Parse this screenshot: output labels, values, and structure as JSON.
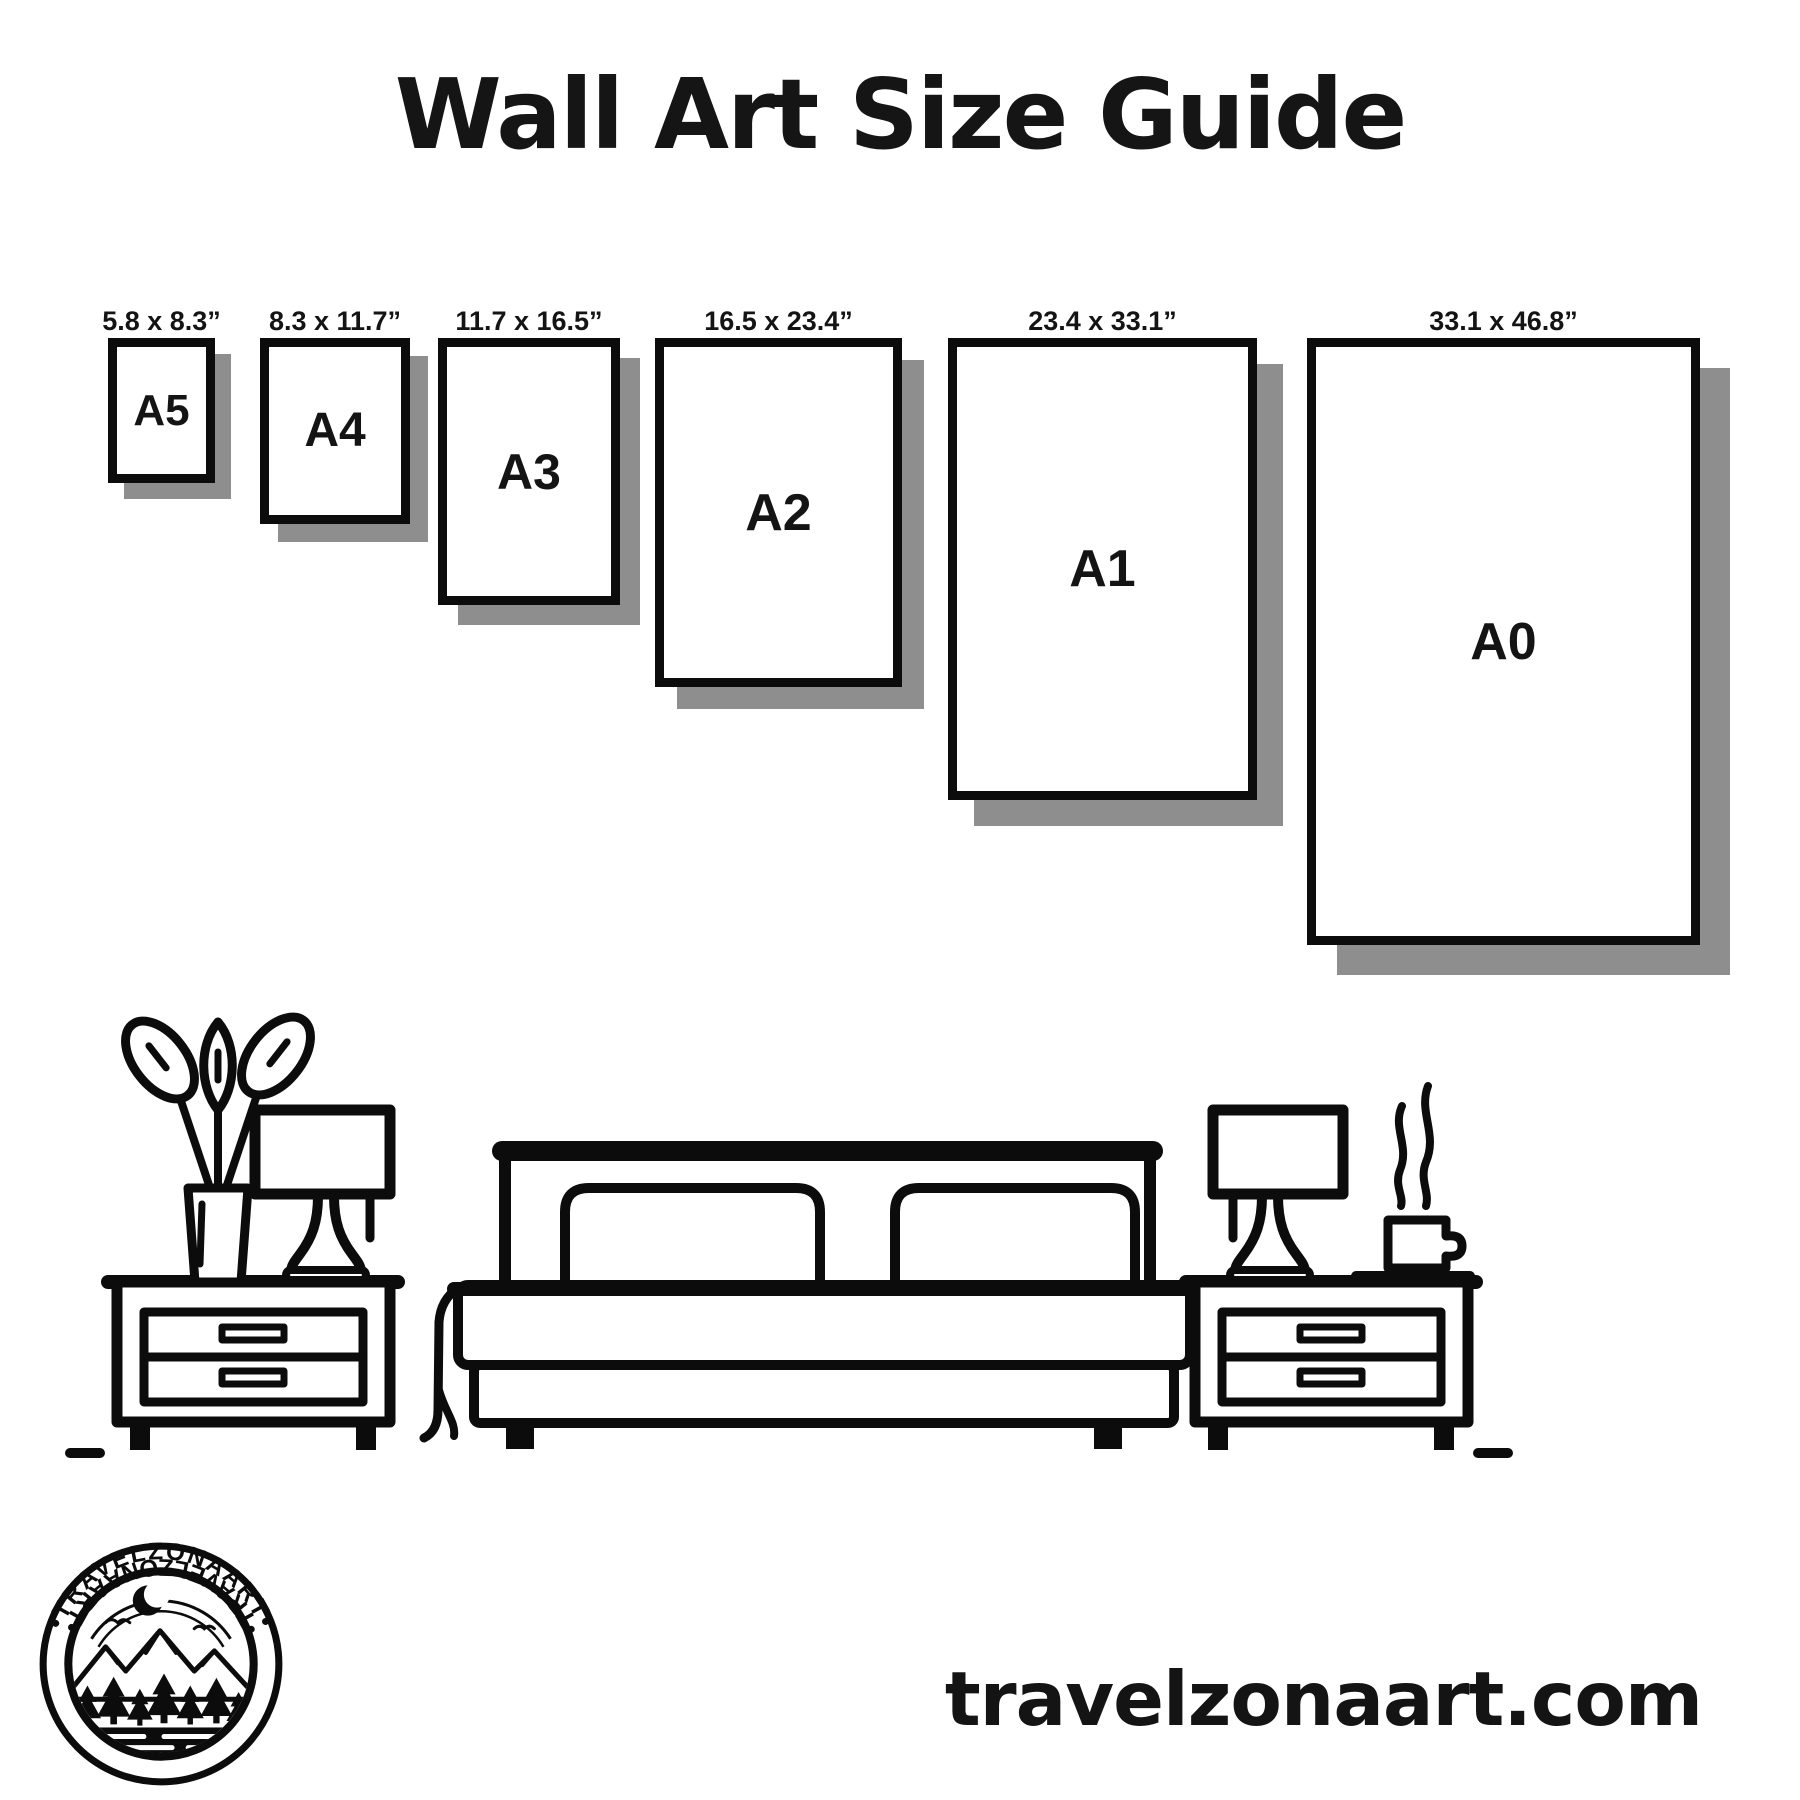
{
  "page": {
    "title": "Wall Art Size Guide",
    "website": "travelzonaart.com"
  },
  "colors": {
    "background": "#ffffff",
    "ink": "#0c0c0c",
    "shadow_gray": "#8e8e8e"
  },
  "sizes": [
    {
      "name": "A5",
      "dimensions": "5.8 x 8.3”",
      "left": 108,
      "top": 338,
      "width": 107,
      "height": 145,
      "shadow": 16,
      "label_size": 44
    },
    {
      "name": "A4",
      "dimensions": "8.3 x 11.7”",
      "left": 260,
      "top": 338,
      "width": 150,
      "height": 186,
      "shadow": 18,
      "label_size": 48
    },
    {
      "name": "A3",
      "dimensions": "11.7 x 16.5”",
      "left": 438,
      "top": 338,
      "width": 182,
      "height": 267,
      "shadow": 20,
      "label_size": 50
    },
    {
      "name": "A2",
      "dimensions": "16.5 x 23.4”",
      "left": 655,
      "top": 338,
      "width": 247,
      "height": 349,
      "shadow": 22,
      "label_size": 52
    },
    {
      "name": "A1",
      "dimensions": "23.4 x 33.1”",
      "left": 948,
      "top": 338,
      "width": 309,
      "height": 462,
      "shadow": 26,
      "label_size": 52
    },
    {
      "name": "A0",
      "dimensions": "33.1 x 46.8”",
      "left": 1307,
      "top": 338,
      "width": 393,
      "height": 607,
      "shadow": 30,
      "label_size": 52
    }
  ],
  "logo": {
    "arc_text_top": "•TRAVELZONAART•",
    "arc_text_bottom": "•TRAVELZONAART•"
  }
}
